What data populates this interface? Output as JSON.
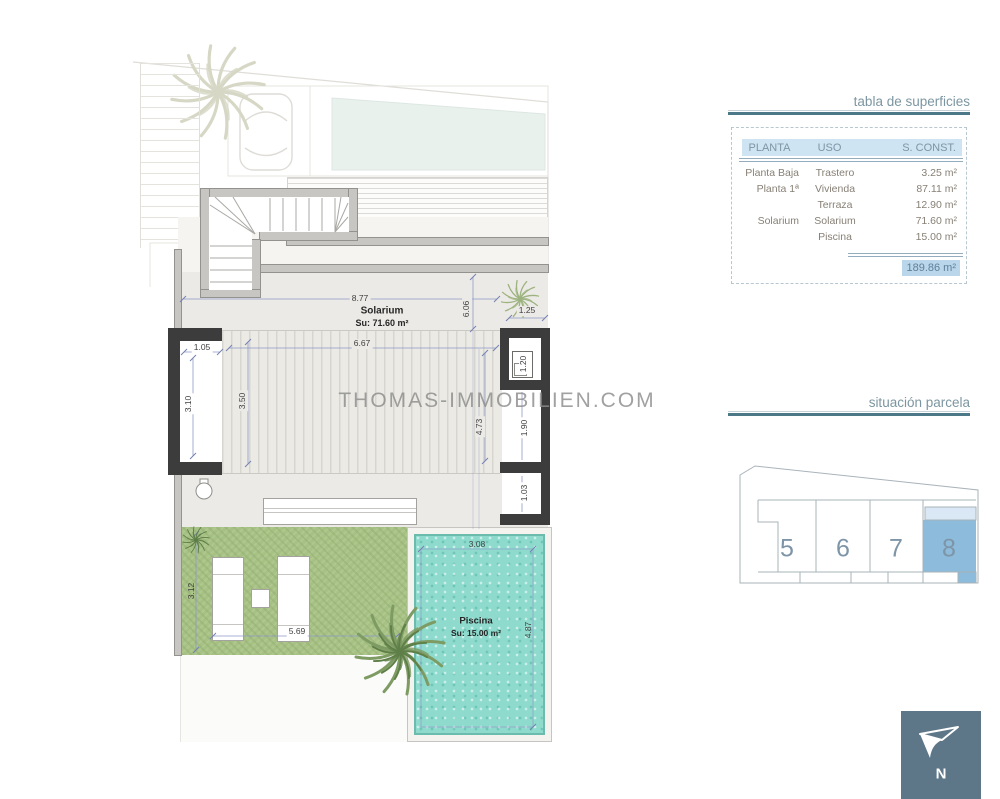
{
  "watermark": "THOMAS-IMMOBILIEN.COM",
  "plan": {
    "solarium_label": "Solarium",
    "solarium_area": "Su: 71.60 m²",
    "piscina_label": "Piscina",
    "piscina_area": "Su: 15.00 m²",
    "dims": {
      "d877": "8.77",
      "d606": "6.06",
      "d125": "1.25",
      "d105": "1.05",
      "d667": "6.67",
      "d350": "3.50",
      "d310": "3.10",
      "d120": "1.20",
      "d473": "4.73",
      "d190": "1.90",
      "d103": "1.03",
      "d312": "3.12",
      "d569": "5.69",
      "d308": "3.08",
      "d487": "4.87"
    }
  },
  "surfaces_table": {
    "title": "tabla de superficies",
    "columns": [
      "PLANTA",
      "USO",
      "S. CONST."
    ],
    "rows": [
      {
        "planta": "Planta Baja",
        "uso": "Trastero",
        "sconst": "3.25 m²"
      },
      {
        "planta": "Planta 1ª",
        "uso": "Vivienda",
        "sconst": "87.11 m²"
      },
      {
        "planta": "",
        "uso": "Terraza",
        "sconst": "12.90 m²"
      },
      {
        "planta": "Solarium",
        "uso": "Solarium",
        "sconst": "71.60 m²"
      },
      {
        "planta": "",
        "uso": "Piscina",
        "sconst": "15.00 m²"
      }
    ],
    "total": "189.86 m²"
  },
  "parcel": {
    "title": "situación parcela",
    "plots": [
      "5",
      "6",
      "7",
      "8"
    ],
    "highlighted_plot": "8"
  },
  "compass": {
    "label": "N"
  },
  "colors": {
    "accent_teal": "#4d7888",
    "table_header_bg": "#cfe4f2",
    "total_highlight": "#b9d6ea",
    "plot_highlight": "#8cbbdb",
    "plot_highlight_light": "#d9e8f4",
    "lawn_green": "#a7c185",
    "pool_teal": "#8edbce",
    "wall_dark": "#3c3c3c",
    "north_box": "#5d7789"
  }
}
